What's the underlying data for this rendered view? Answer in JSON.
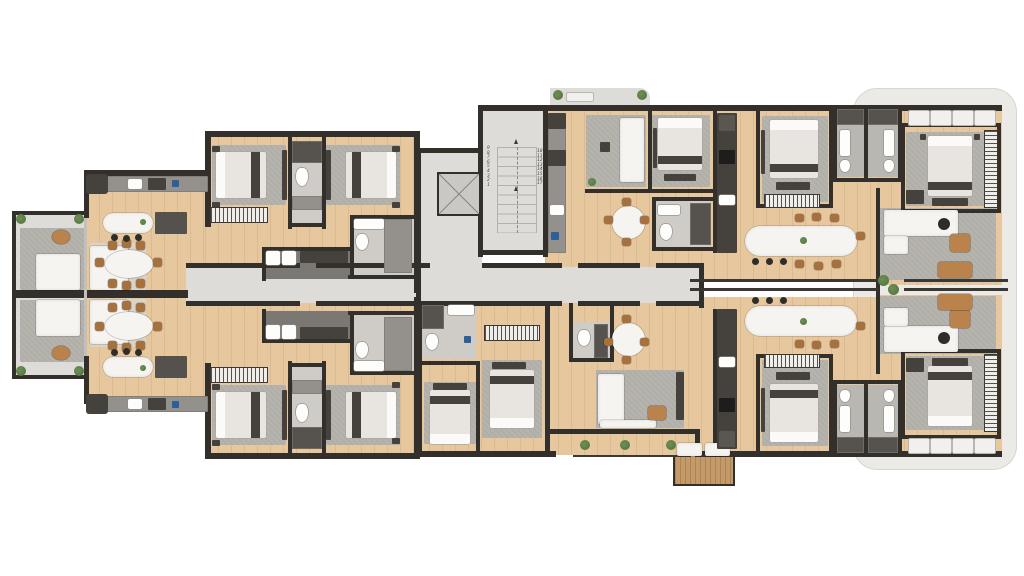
{
  "diagram": {
    "type": "residential-floor-plan",
    "view": "top-down 3d architectural render",
    "units_visible": 6,
    "core": [
      "switchback staircase with 17 numbered treads",
      "elevator shaft",
      "central corridor"
    ],
    "features": [
      "wood flooring",
      "gray area rugs",
      "kitchen islands",
      "oval dining tables",
      "balconies with planters",
      "sun-lounger deck"
    ]
  },
  "stairs": {
    "down_flight": [
      "9",
      "8",
      "7",
      "6",
      "5",
      "4",
      "3",
      "2",
      "1"
    ],
    "up_flight": [
      "10",
      "11",
      "12",
      "13",
      "14",
      "15",
      "16",
      "17"
    ]
  },
  "colors": {
    "wood": "#e7c79d",
    "wall": "#33302c",
    "stone": "#dedcd8",
    "stonedark": "#cfccc8",
    "rug": "#b1aea8",
    "ruglight": "#dad3c7",
    "furn": "#f5f4f1",
    "counter": "#45423e",
    "appliance": "#94918c",
    "chairwood": "#a5713f",
    "leather": "#b9834b",
    "plant": "#4f7040",
    "blue": "#2e5f96",
    "deck": "#c49a68"
  }
}
